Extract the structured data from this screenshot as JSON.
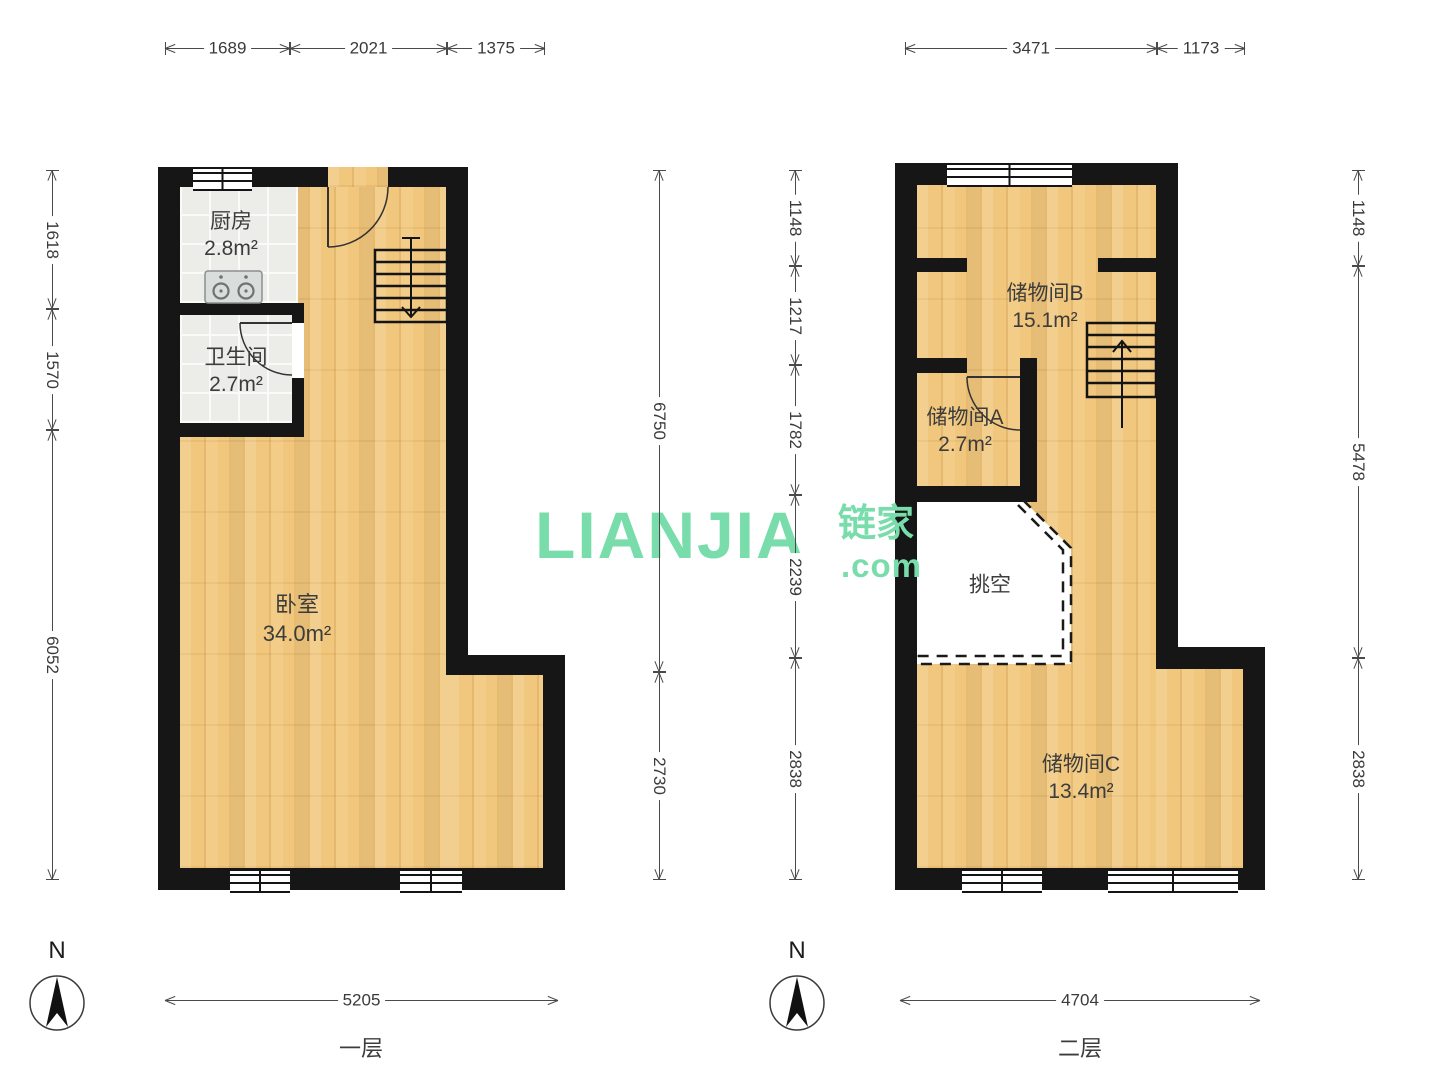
{
  "watermark": {
    "logo": "LIANJIA",
    "cn": "链家",
    "dotcom": ".com"
  },
  "floor1": {
    "name": "一层",
    "compass": "N",
    "rooms": {
      "kitchen": {
        "label": "厨房",
        "area": "2.8m²"
      },
      "bath": {
        "label": "卫生间",
        "area": "2.7m²"
      },
      "bedroom": {
        "label": "卧室",
        "area": "34.0m²"
      }
    },
    "dims": {
      "top": [
        "1689",
        "2021",
        "1375"
      ],
      "left": [
        "1618",
        "1570",
        "6052"
      ],
      "right": [
        "6750",
        "2730"
      ],
      "bottom": [
        "5205"
      ]
    }
  },
  "floor2": {
    "name": "二层",
    "compass": "N",
    "rooms": {
      "storage_b": {
        "label": "储物间B",
        "area": "15.1m²"
      },
      "storage_a": {
        "label": "储物间A",
        "area": "2.7m²"
      },
      "void": {
        "label": "挑空"
      },
      "storage_c": {
        "label": "储物间C",
        "area": "13.4m²"
      }
    },
    "dims": {
      "top": [
        "3471",
        "1173"
      ],
      "left": [
        "1148",
        "1217",
        "1782",
        "2239",
        "2838"
      ],
      "right": [
        "1148",
        "5478",
        "2838"
      ],
      "bottom": [
        "4704"
      ]
    }
  },
  "colors": {
    "wall": "#161616",
    "wood": "#F1C77D",
    "tile": "#ECECE9",
    "watermark_green": "#79DDAB"
  }
}
